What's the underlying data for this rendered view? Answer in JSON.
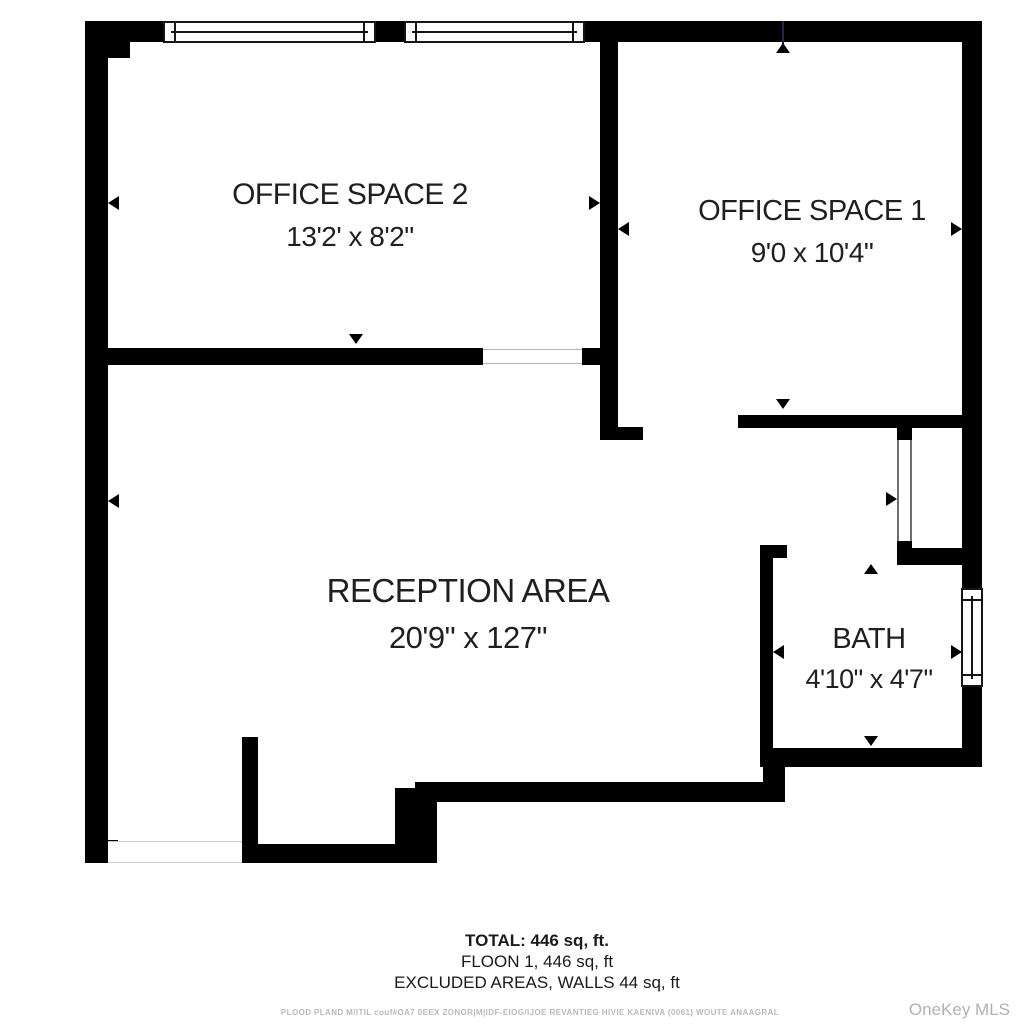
{
  "rooms": {
    "office2": {
      "name": "OFFICE SPACE 2",
      "dims": "13'2' x 8'2\""
    },
    "office1": {
      "name": "OFFICE SPACE 1",
      "dims": "9'0 x 10'4\""
    },
    "reception": {
      "name": "RECEPTION AREA",
      "dims": "20'9\" x 127\""
    },
    "bath": {
      "name": "BATH",
      "dims": "4'10\" x 4'7\""
    }
  },
  "summary": {
    "total": "TOTAL: 446 sq, ft.",
    "floor": "FLOON 1, 446 sq, ft",
    "excluded": "EXCLUDED AREAS, WALLS 44 sq, ft"
  },
  "fine_print": "PLOOD PLAND M/ITIL couf#OA7 0EEX ZONOR|M|IDF-EIOG/IJOE REVANTIEG HIVIE KAENIVA (0061) WOUTE ANAAGRAL",
  "watermark": "OneKey MLS",
  "colors": {
    "wall": "#000000",
    "background": "#ffffff",
    "text": "#1f1f1f",
    "fine_print": "#b9b9b9",
    "watermark": "#aeb2b7",
    "marker_blue": "#1b2653"
  }
}
